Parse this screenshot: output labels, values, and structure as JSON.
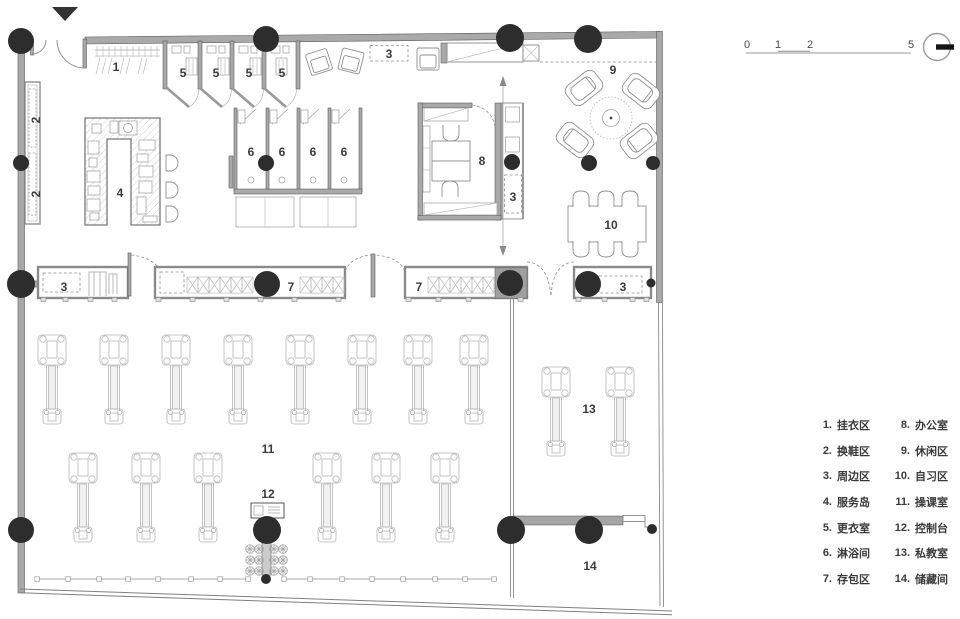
{
  "plan": {
    "labels": {
      "n1": "1",
      "n2": "2",
      "n3": "3",
      "n4": "4",
      "n5": "5",
      "n6": "6",
      "n7": "7",
      "n8": "8",
      "n9": "9",
      "n10": "10",
      "n11": "11",
      "n12": "12",
      "n13": "13",
      "n14": "14"
    }
  },
  "scalebar": {
    "ticks": [
      "0",
      "1",
      "2",
      "5"
    ]
  },
  "legend": {
    "items": [
      {
        "num": "1.",
        "label": "挂衣区"
      },
      {
        "num": "2.",
        "label": "换鞋区"
      },
      {
        "num": "3.",
        "label": "周边区"
      },
      {
        "num": "4.",
        "label": "服务岛"
      },
      {
        "num": "5.",
        "label": "更衣室"
      },
      {
        "num": "6.",
        "label": "淋浴间"
      },
      {
        "num": "7.",
        "label": "存包区"
      },
      {
        "num": "8.",
        "label": "办公室"
      },
      {
        "num": "9.",
        "label": "休闲区"
      },
      {
        "num": "10.",
        "label": "自习区"
      },
      {
        "num": "11.",
        "label": "操课室"
      },
      {
        "num": "12.",
        "label": "控制台"
      },
      {
        "num": "13.",
        "label": "私教室"
      },
      {
        "num": "14.",
        "label": "储藏间"
      }
    ]
  },
  "colors": {
    "column": "#2d2d2d",
    "wall": "#a9a9a9",
    "text": "#3b3b3b"
  }
}
